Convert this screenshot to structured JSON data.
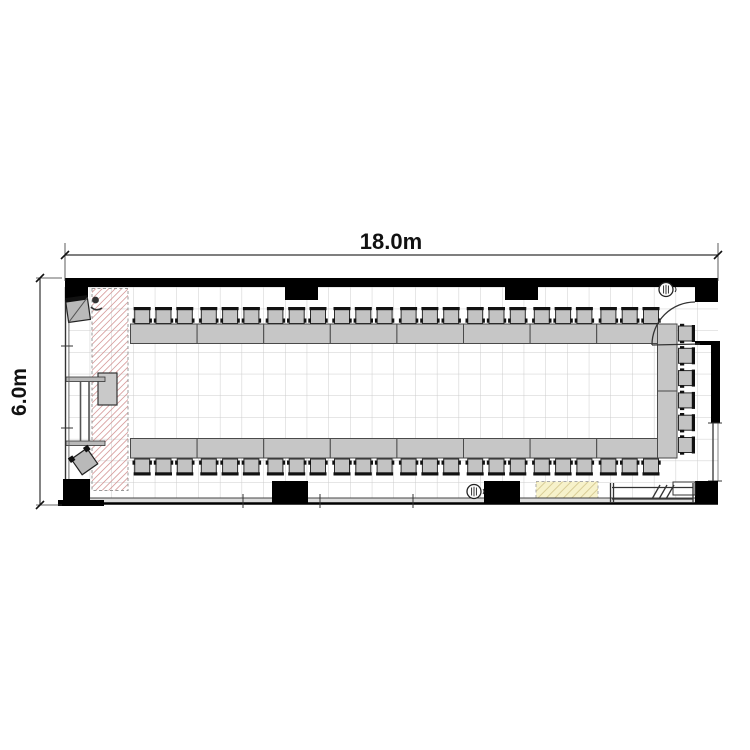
{
  "plan": {
    "dimension_width_label": "18.0m",
    "dimension_height_label": "6.0m"
  },
  "colors": {
    "wall": "#000000",
    "grid_line": "#cccccc",
    "table_fill": "#c6c6c6",
    "table_stroke": "#4a4a4a",
    "chair_fill": "#c3c3c3",
    "chair_stroke": "#2a2a2a",
    "chair_back": "#111111",
    "stage_hatch_line": "#d08c8c",
    "stage_border": "#999999",
    "storage_fill": "#f7f2cb",
    "storage_hatch_line": "#d9cd96",
    "storage_border": "#aaaaaa",
    "podium_fill": "#c9c9c9",
    "equipment_fill": "#b9b9b9",
    "dimension_line": "#333333",
    "window_band": "#dcdcdc",
    "thin_line": "#444444"
  },
  "furniture": {
    "top_row": {
      "tables": 8,
      "chairs": 24
    },
    "bottom_row": {
      "tables": 8,
      "chairs": 24
    },
    "right_row": {
      "tables": 2,
      "chairs": 6
    },
    "chairs_per_table": 3,
    "total_chairs": 54
  },
  "icons": {
    "top_left": "av-monitor-icon",
    "bottom_left": "speaker-icon",
    "top_right": "drinking-fountain-icon",
    "bottom_center": "drinking-fountain-icon"
  }
}
